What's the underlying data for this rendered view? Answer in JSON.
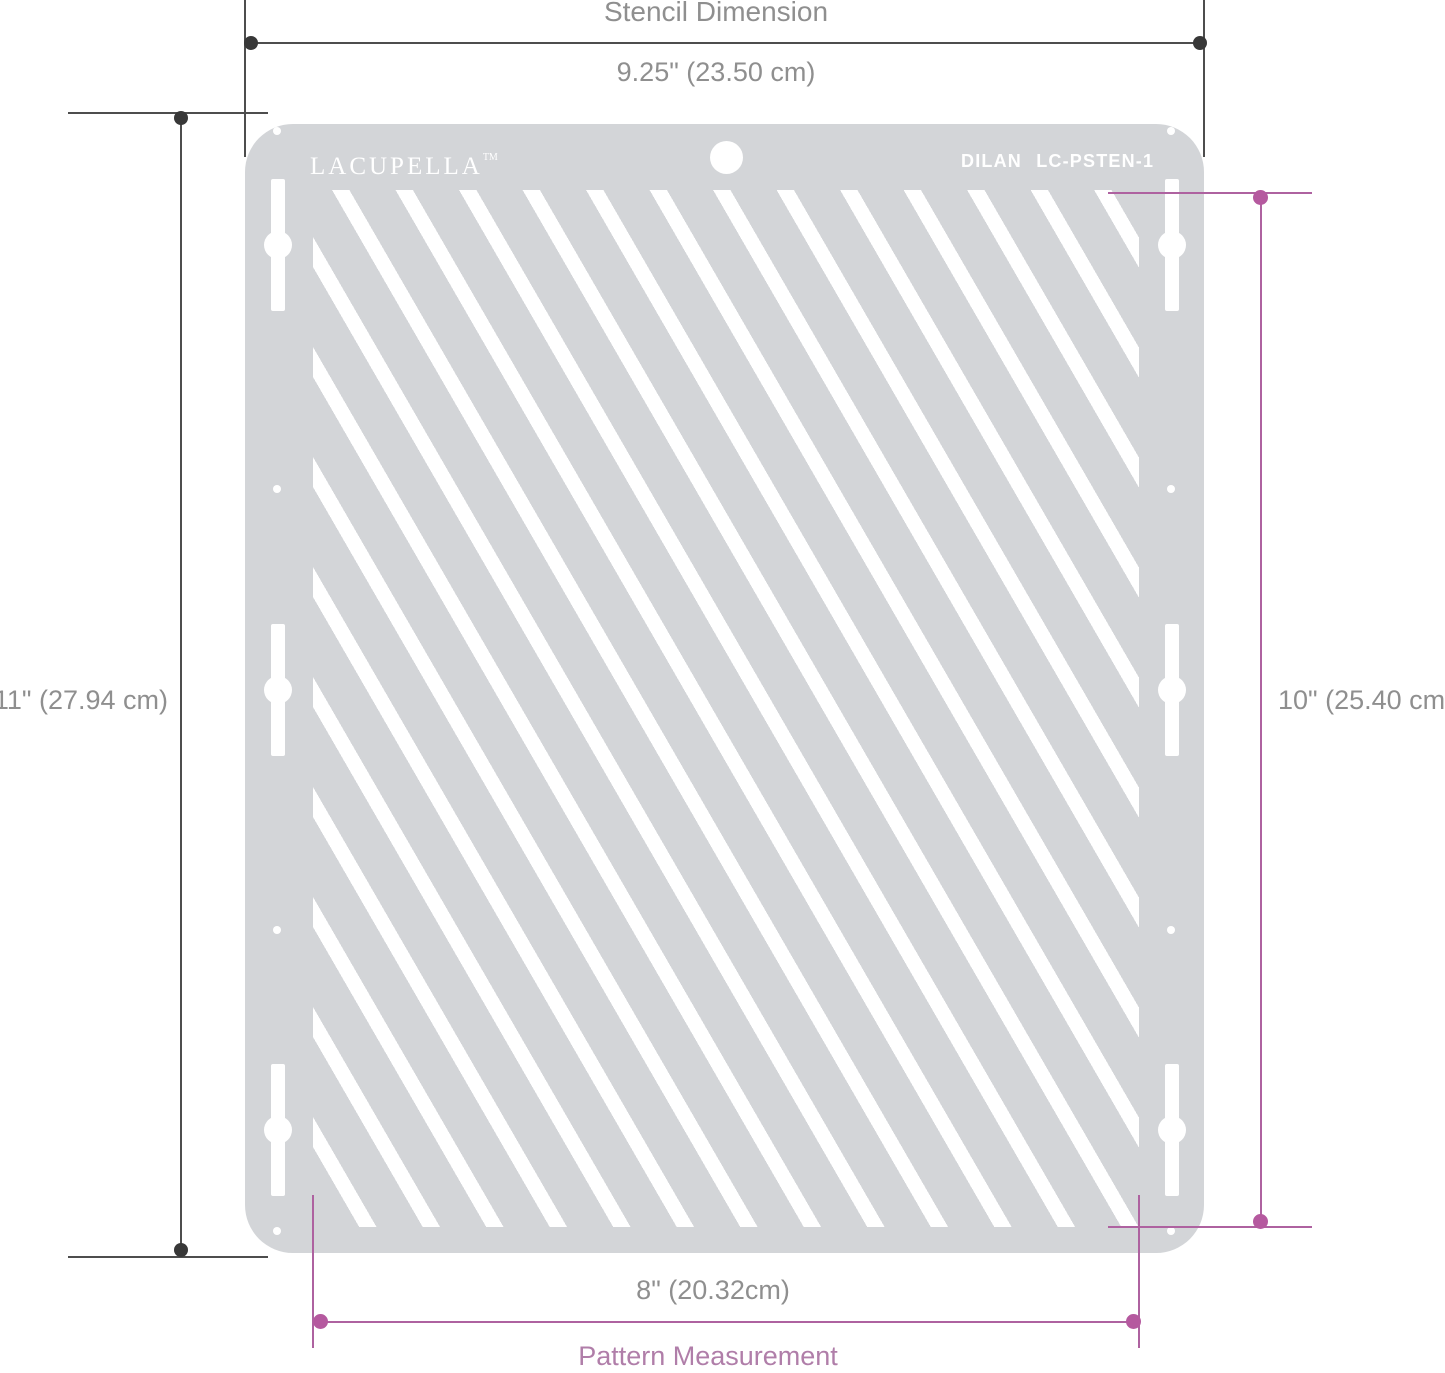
{
  "dimensions": {
    "stencil": {
      "title": "Stencil Dimension",
      "width_label": "9.25\" (23.50 cm)",
      "height_label": "11\" (27.94 cm)"
    },
    "pattern": {
      "title": "Pattern Measurement",
      "width_label": "8\" (20.32cm)",
      "height_label": "10\" (25.40 cm)"
    }
  },
  "stencil": {
    "brand": "LACUPELLA",
    "trademark": "TM",
    "model": "DILAN LC-PSTEN-1"
  },
  "colors": {
    "stencil_gray": "#d3d5d8",
    "pattern_white": "#ffffff",
    "dim_line_dark": "#4d4d4d",
    "dim_dot_dark": "#383838",
    "accent_pink": "#b5599f",
    "accent_pink_line": "#ae62a0",
    "pattern_label_pink": "#b07ea9",
    "label_gray": "#8f8f8f",
    "page_bg": "#ffffff"
  }
}
